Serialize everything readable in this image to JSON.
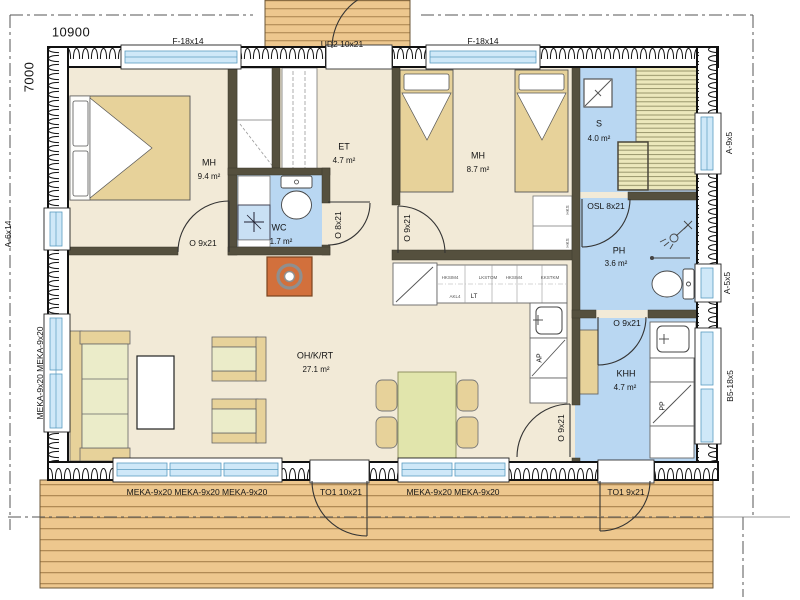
{
  "plan": {
    "dimensions": {
      "width": "10900",
      "height": "7000"
    },
    "rooms": [
      {
        "name": "MH",
        "area": "9.4 m²"
      },
      {
        "name": "ET",
        "area": "4.7 m²"
      },
      {
        "name": "WC",
        "area": "1.7 m²"
      },
      {
        "name": "MH",
        "area": "8.7 m²"
      },
      {
        "name": "S",
        "area": "4.0 m²"
      },
      {
        "name": "PH",
        "area": "3.6 m²"
      },
      {
        "name": "OH/K/RT",
        "area": "27.1 m²"
      },
      {
        "name": "KHH",
        "area": "4.7 m²"
      }
    ],
    "windows": {
      "f1": "F-18x14",
      "f2": "F-18x14",
      "a6x14": "A-6x14",
      "meka_left": "MEKA-9x20 MEKA-9x20",
      "a9x5": "A-9x5",
      "a5x5": "A-5x5",
      "b5_18x5": "B5-18x5",
      "meka_bottom_triple": "MEKA-9x20 MEKA-9x20 MEKA-9x20",
      "meka_bottom_double": "MEKA-9x20 MEKA-9x20"
    },
    "doors": {
      "front": "UD2 10x21",
      "bedroom1": "O 9x21",
      "wc": "O 8x21",
      "bedroom2": "O 9x21",
      "sauna": "OSL 8x21",
      "ph_to_khh": "O 9x21",
      "oh_to_khh": "O 9x21",
      "terrace_main": "TO1 10x21",
      "terrace_khh": "TO1 9x21"
    },
    "kitchen": {
      "dishwasher": "AP",
      "stove": "LT",
      "cabinets": [
        "HKSIM4",
        "LKSTOM",
        "HKSIM4",
        "KKSTKM",
        "AKL4"
      ]
    },
    "utility": {
      "washer": "PP"
    },
    "closets": {
      "codes": [
        "HKS",
        "HKS"
      ]
    },
    "colors": {
      "wet_room": "#b9d7f2",
      "floor": "#f2ead7",
      "wood_deck": "#edc78e",
      "furniture_tan": "#e7d29a",
      "furniture_green": "#ebecc9",
      "fireplace": "#d2703c",
      "glazing": "#cfe8f8",
      "interior_wall": "#55503e"
    }
  }
}
